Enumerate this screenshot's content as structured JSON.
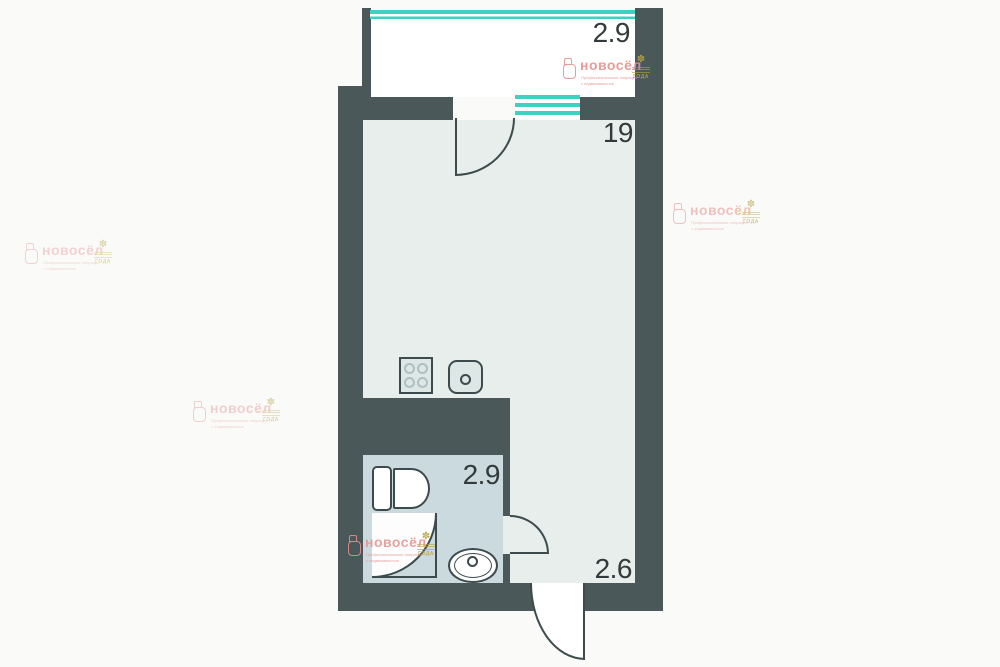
{
  "colors": {
    "page-bg": "#fafaf9",
    "wall": "#4a585a",
    "room": "#e7eeeb",
    "bathroom": "#cbdade",
    "balcony": "#ffffff",
    "window": "#3ed0c0",
    "outline": "#3e4b4d",
    "label": "#333a3b",
    "fixture-fill": "#dde7e5",
    "logo-pink": "#e4938f",
    "logo-gold": "#b3a042"
  },
  "rooms": {
    "balcony": {
      "area": "2.9"
    },
    "living": {
      "area": "19"
    },
    "bathroom": {
      "area": "2.9"
    },
    "hallway": {
      "area": "2.6"
    }
  },
  "fixtures": {
    "stove": "stove-icon",
    "kitchen_sink": "kitchen-sink-icon",
    "toilet": "toilet-icon",
    "shower": "shower-icon",
    "bathroom_sink": "bathroom-sink-icon"
  },
  "logo": {
    "name": "новосёл",
    "tagline_line1": "Профессиональные операции",
    "tagline_line2": "с недвижимостью",
    "award_flower": "✽",
    "award_text": "ГОДА"
  }
}
